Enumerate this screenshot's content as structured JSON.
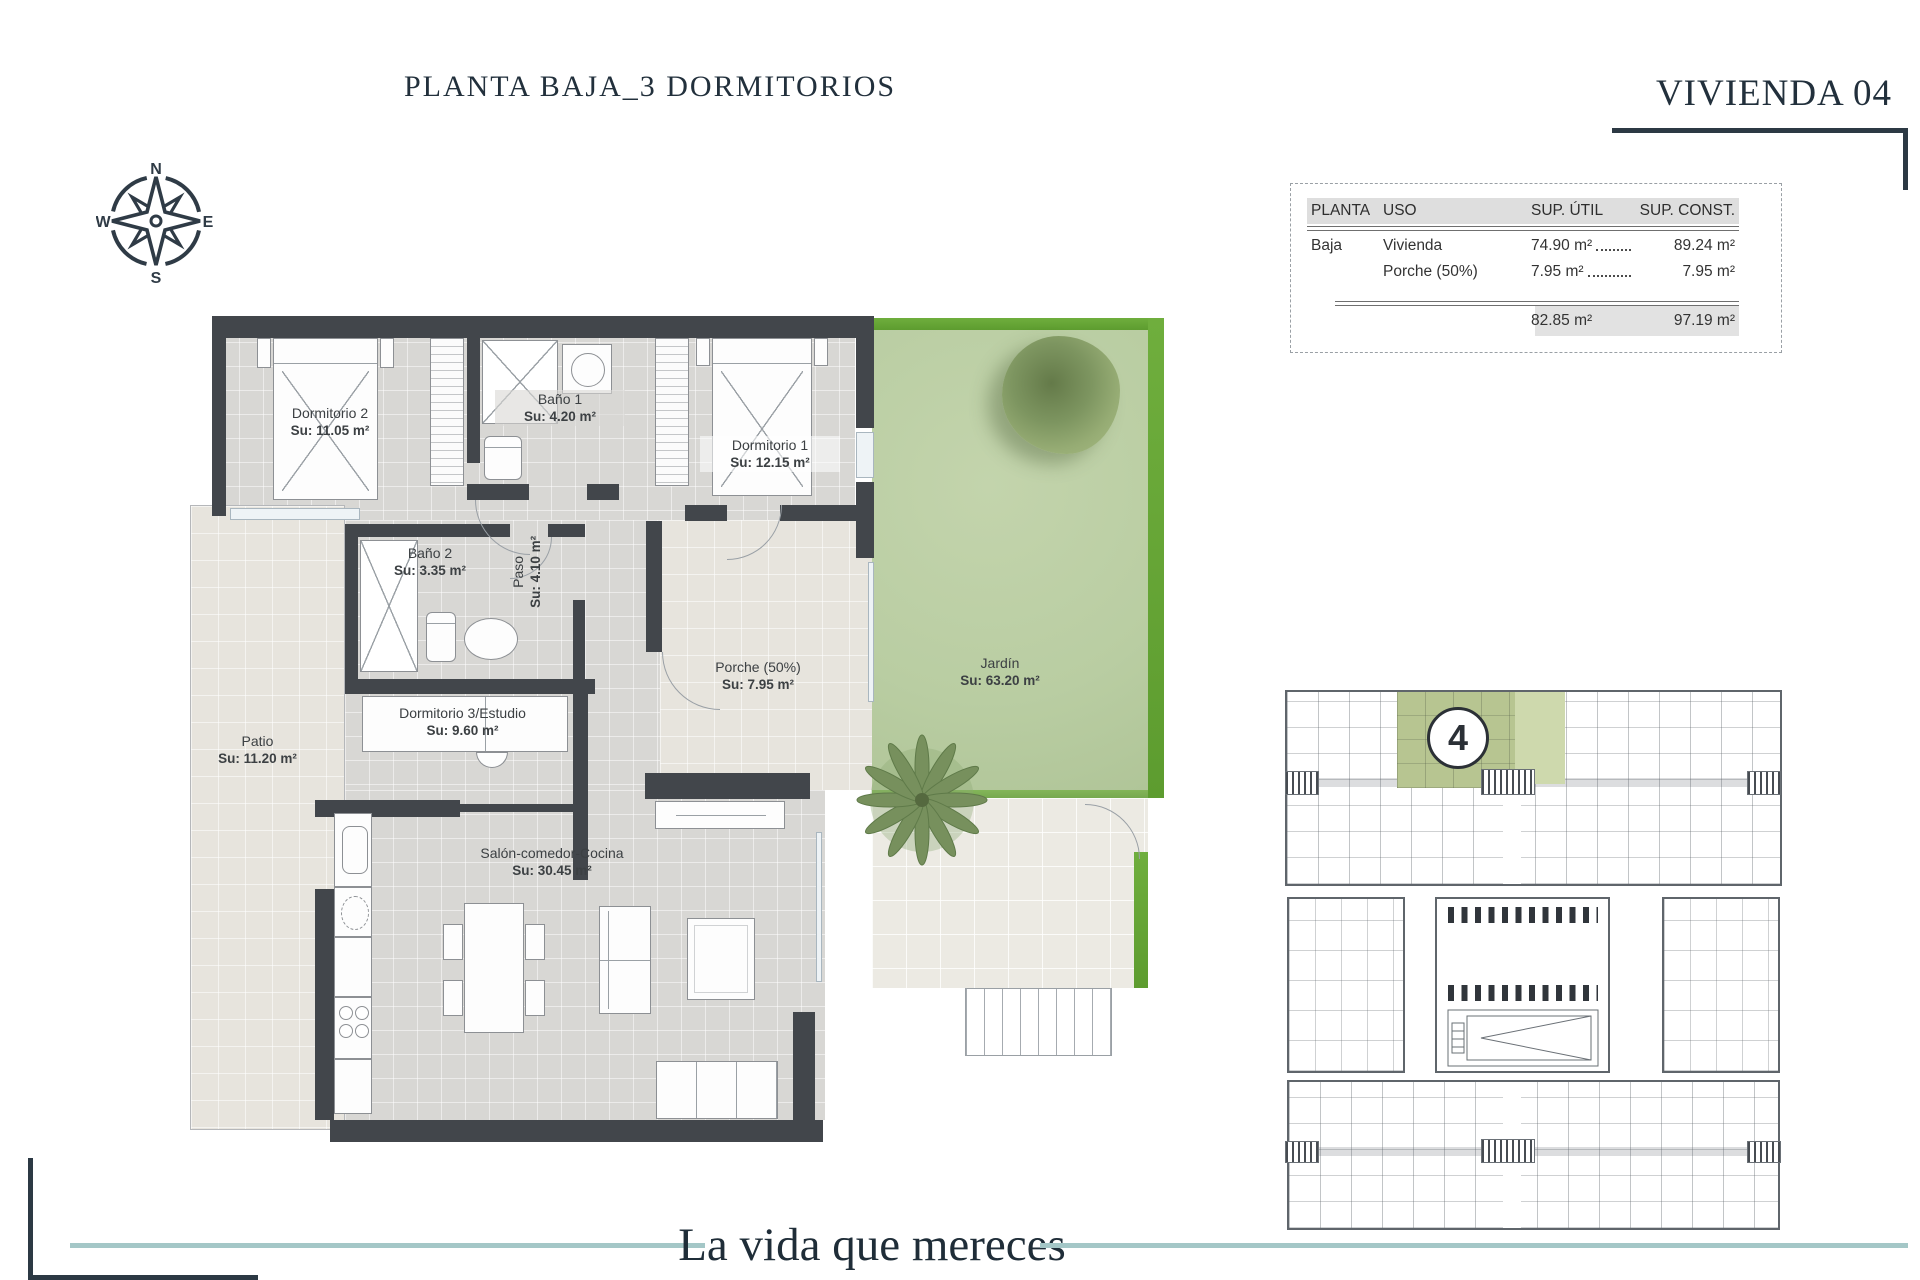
{
  "header": {
    "title": "PLANTA BAJA_3 DORMITORIOS",
    "vivienda": "VIVIENDA 04"
  },
  "compass": {
    "n": "N",
    "e": "E",
    "s": "S",
    "w": "W"
  },
  "area_table": {
    "headers": {
      "planta": "PLANTA",
      "uso": "USO",
      "util": "SUP. ÚTIL",
      "const": "SUP. CONST."
    },
    "rows": [
      {
        "planta": "Baja",
        "uso": "Vivienda",
        "util": "74.90 m²",
        "const": "89.24 m²"
      },
      {
        "planta": "",
        "uso": "Porche (50%)",
        "util": "7.95 m²",
        "const": "7.95 m²"
      }
    ],
    "totals": {
      "util": "82.85 m²",
      "const": "97.19 m²"
    }
  },
  "floorplan": {
    "rooms": {
      "dormitorio2": {
        "name": "Dormitorio 2",
        "area": "Su: 11.05 m²"
      },
      "bano1": {
        "name": "Baño 1",
        "area": "Su: 4.20 m²"
      },
      "dormitorio1": {
        "name": "Dormitorio 1",
        "area": "Su: 12.15 m²"
      },
      "paso": {
        "name": "Paso",
        "area": "Su: 4.10 m²"
      },
      "bano2": {
        "name": "Baño 2",
        "area": "Su: 3.35 m²"
      },
      "patio": {
        "name": "Patio",
        "area": "Su: 11.20 m²"
      },
      "dormitorio3": {
        "name": "Dormitorio 3/Estudio",
        "area": "Su: 9.60 m²"
      },
      "porche": {
        "name": "Porche (50%)",
        "area": "Su: 7.95 m²"
      },
      "jardin": {
        "name": "Jardín",
        "area": "Su: 63.20 m²"
      },
      "salon": {
        "name": "Salón-comedor-Cocina",
        "area": "Su: 30.45 m²"
      }
    }
  },
  "siteplan": {
    "unit_number": "4"
  },
  "footer": {
    "tagline": "La vida que mereces"
  },
  "colors": {
    "ink": "#22303c",
    "wall": "#42464b",
    "accent_teal": "#a4c7c7",
    "garden_green": "#b9cda2",
    "garden_border_green": "#63a331",
    "highlight_unit_green": "#b7c591"
  }
}
